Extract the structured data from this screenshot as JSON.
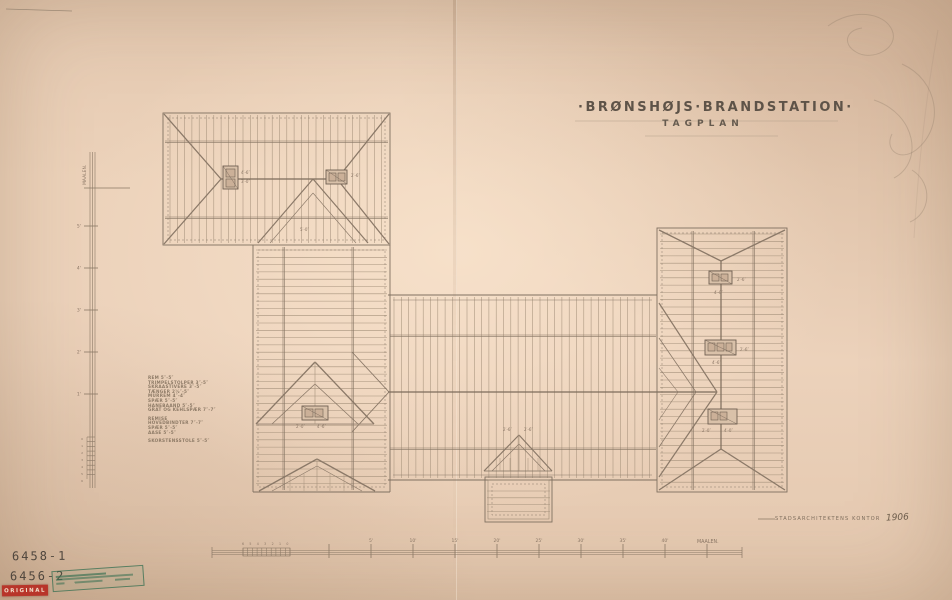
{
  "title": {
    "line1": "·BRØNSHØJS·BRANDSTATION·",
    "line2": "TAGPLAN"
  },
  "signature": {
    "office": "STADSARCHITEKTENS KONTOR",
    "year": "1906"
  },
  "spec_list": [
    "REM 5″-5″",
    "TRIMPELSTOLPER 3″-5″",
    "SKRAASTIVERE 3″-5″",
    "TÆNGER 2½″-5″",
    "MURREM 4″-4″",
    "SPÆR 5″-5″",
    "HANEBAAND 5″-5″",
    "GRAT OG KEHLSPÆR 7″-7″",
    "",
    "REMISE",
    "HOVEDBINDTER 7″-7″",
    "SPÆR 5″-5″",
    "AASE 5″-5″",
    "",
    "SKORSTENSSTOLE 5″-5″"
  ],
  "scales": {
    "bottom": {
      "sub_labels": [
        "6",
        "5",
        "4",
        "3",
        "2",
        "1",
        "0"
      ],
      "major_labels": [
        "5'",
        "10'",
        "15'",
        "20'",
        "25'",
        "30'",
        "35'",
        "40'"
      ],
      "unit": "MAALEN."
    },
    "left": {
      "unit": "MAALEN.",
      "major_labels": [
        "5'",
        "4'",
        "3'",
        "2'",
        "1'"
      ],
      "sub_labels": [
        "0",
        "1",
        "2",
        "3",
        "4",
        "5",
        "6"
      ]
    }
  },
  "annotations": [
    {
      "x": 241,
      "y": 174,
      "t": "4′-6″"
    },
    {
      "x": 241,
      "y": 183,
      "t": "3′-0″"
    },
    {
      "x": 351,
      "y": 177,
      "t": "2′-6″"
    },
    {
      "x": 300,
      "y": 231,
      "t": "5′-0″"
    },
    {
      "x": 296,
      "y": 428,
      "t": "2′-0″"
    },
    {
      "x": 317,
      "y": 428,
      "t": "4′-6″"
    },
    {
      "x": 737,
      "y": 281,
      "t": "2′-6″"
    },
    {
      "x": 714,
      "y": 294,
      "t": "4′-0″"
    },
    {
      "x": 740,
      "y": 351,
      "t": "2′-6″"
    },
    {
      "x": 712,
      "y": 364,
      "t": "4′-6″"
    },
    {
      "x": 702,
      "y": 432,
      "t": "2′-0″"
    },
    {
      "x": 724,
      "y": 432,
      "t": "4′-0″"
    },
    {
      "x": 503,
      "y": 431,
      "t": "2′-6″"
    },
    {
      "x": 524,
      "y": 431,
      "t": "2′-6″"
    }
  ],
  "archive": {
    "number1": "6458-1",
    "number2": "6456-2",
    "red_stamp": "ORIGINAL"
  },
  "colors": {
    "paper": "#ecd2ba",
    "rafter": "#a6927c",
    "line_dark": "#7f7060",
    "hip": "#8b7968",
    "chimney_fill": "#d9c1a9",
    "annotation": "#8a7665",
    "stamp_green": "#3f7d5a",
    "stamp_red": "#b8352a",
    "pencil": "#4f463d"
  }
}
